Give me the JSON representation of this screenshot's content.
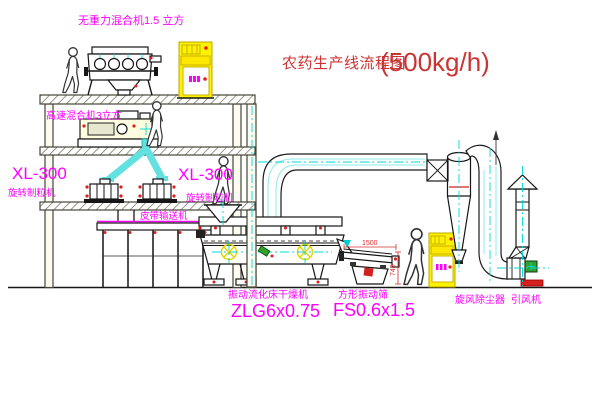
{
  "title": {
    "text": "农药生产线流程图",
    "capacity": "(500kg/h)"
  },
  "equipment": {
    "gravity_mixer": {
      "label": "无重力混合机1.5 立方"
    },
    "high_speed_mixer": {
      "label": "高速混合机3立方"
    },
    "granulator_left": {
      "model": "XL-300",
      "name": "旋转制粒机"
    },
    "granulator_center": {
      "model": "XL-300",
      "name": "旋转制粒机"
    },
    "belt_conveyor": {
      "name": "皮带输送机"
    },
    "fluid_bed_dryer": {
      "name": "振动流化床干燥机",
      "model": "ZLG6x0.75"
    },
    "vibrating_sieve": {
      "name": "方形振动筛",
      "model": "FS0.6x1.5",
      "dim_width": "1500",
      "dim_height": "745"
    },
    "cyclone": {
      "name": "旋风除尘器"
    },
    "induced_draft_fan": {
      "name": "引风机"
    }
  },
  "colors": {
    "label_magenta": "#FF00FF",
    "title_red": "#CC3333",
    "pipe_cyan": "#00D8D8",
    "cabinet_yellow": "#FFF200",
    "alert_red": "#E02020",
    "motor_green": "#2FA32F",
    "structure_olive": "#45453A"
  }
}
